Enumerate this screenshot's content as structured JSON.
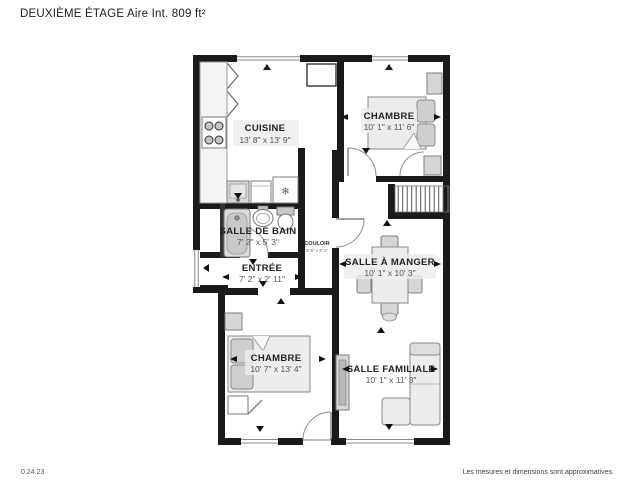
{
  "header": {
    "title": "DEUXIÈME ÉTAGE Aire Int. 809 ft²"
  },
  "rooms": {
    "cuisine": {
      "name": "CUISINE",
      "dims": "13' 8\" x 13' 9\""
    },
    "chambre1": {
      "name": "CHAMBRE",
      "dims": "10' 1\" x 11' 6\""
    },
    "salle_de_bain": {
      "name": "SALLE DE BAIN",
      "dims": "7' 2\" x 5' 3\""
    },
    "couloir": {
      "name": "COULOIR",
      "dims": "3' 6\" x 9' 1\""
    },
    "entree": {
      "name": "ENTRÉE",
      "dims": "7' 2\" x 2' 11\""
    },
    "salle_a_manger": {
      "name": "SALLE À MANGER",
      "dims": "10' 1\" x 10' 3\""
    },
    "chambre2": {
      "name": "CHAMBRE",
      "dims": "10' 7\" x 13' 4\""
    },
    "salle_familiale": {
      "name": "SALLE FAMILIALE",
      "dims": "10' 1\" x 11' 3\""
    }
  },
  "icons": {
    "fridge_snowflake": "❄"
  },
  "footer": {
    "date": "0.24.23",
    "disclaimer": "Les mesures et dimensions sont approximatives."
  },
  "colors": {
    "wall": "#1a1a1a",
    "furniture_fill": "#ececec",
    "furniture_stroke": "#888888",
    "text_primary": "#222222",
    "text_dims": "#555555"
  }
}
